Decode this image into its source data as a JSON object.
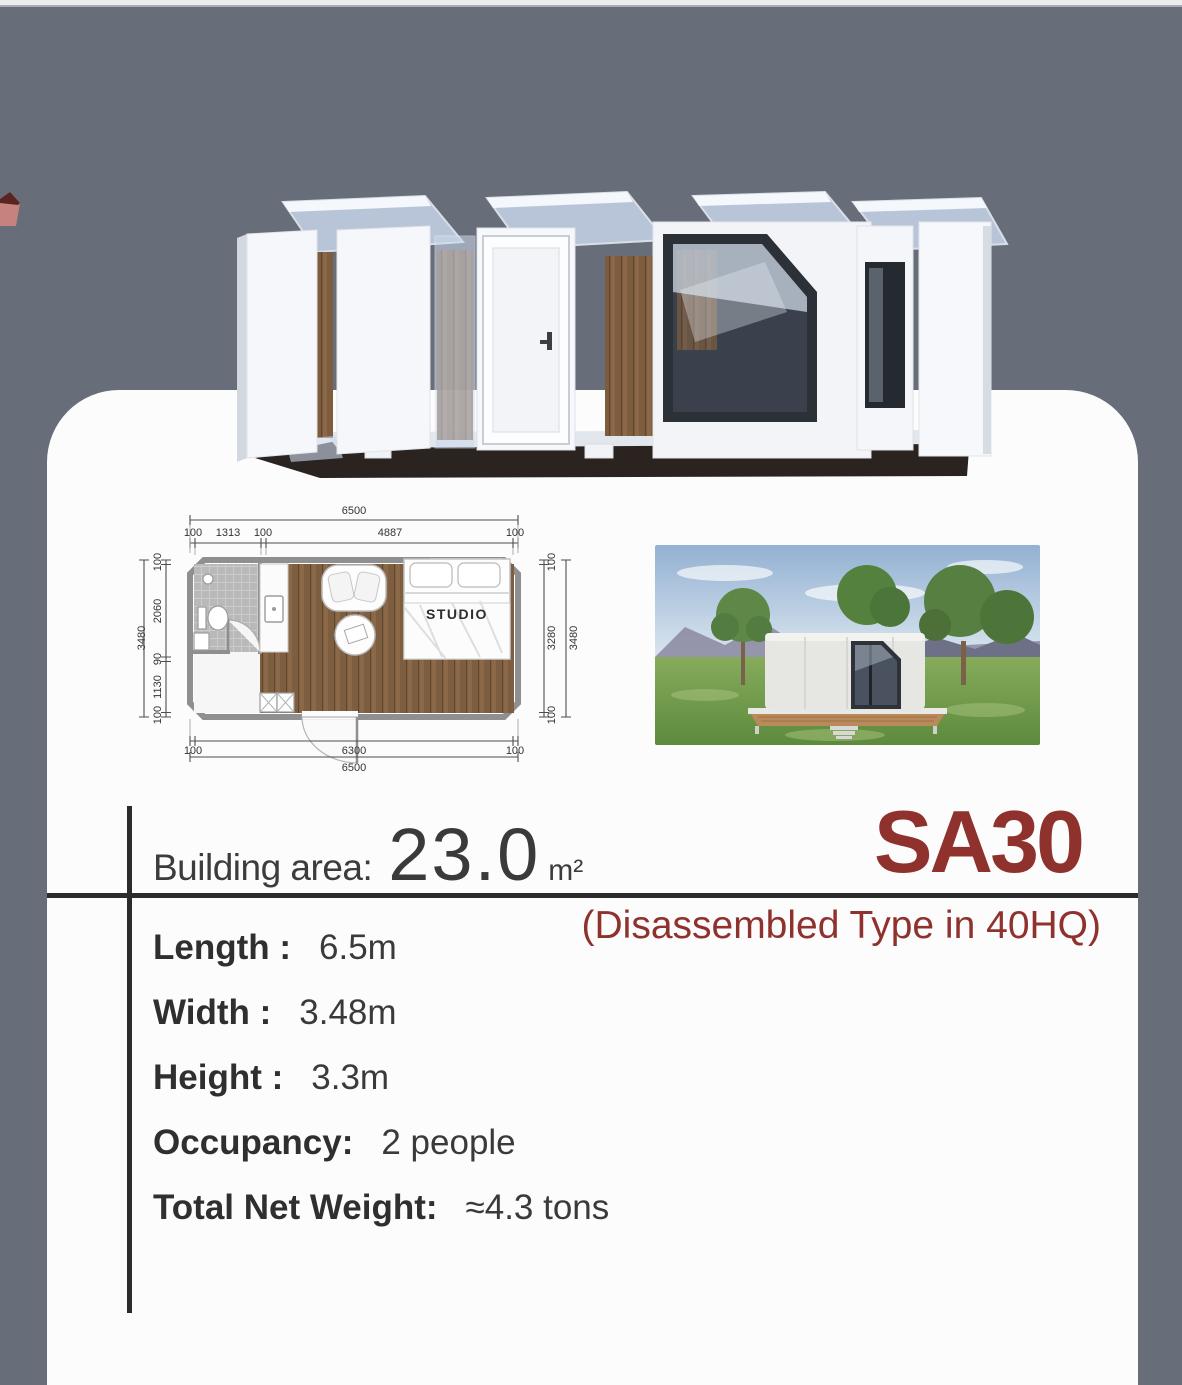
{
  "header": {
    "building_area_label": "Building area:",
    "building_area_value": "23.0",
    "building_area_unit": "m²",
    "model_code": "SA30",
    "model_subtitle": "(Disassembled Type in 40HQ)"
  },
  "specs": [
    {
      "label": "Length :",
      "value": "6.5m"
    },
    {
      "label": "Width :",
      "value": "3.48m"
    },
    {
      "label": "Height :",
      "value": "3.3m"
    },
    {
      "label": "Occupancy:",
      "value": "2 people"
    },
    {
      "label": "Total Net Weight:",
      "value": "≈4.3 tons"
    }
  ],
  "floor_plan": {
    "room_label": "STUDIO",
    "top_total": "6500",
    "top_segments": [
      "100",
      "1313",
      "100",
      "4887",
      "100"
    ],
    "left_total": "3480",
    "left_segments": [
      "100",
      "2060",
      "90",
      "1130",
      "100"
    ],
    "right_total": "3480",
    "right_segments": [
      "100",
      "3280",
      "100"
    ],
    "bottom_segments": [
      "100",
      "6300",
      "100"
    ],
    "bottom_total": "6500"
  },
  "colors": {
    "background_gray": "#676e79",
    "card_white": "#fcfcfd",
    "accent_red": "#8f322d",
    "text_dark": "#3c3c3c",
    "divider_black": "#2b2b2b",
    "wood_floor": "#7e5e40"
  }
}
